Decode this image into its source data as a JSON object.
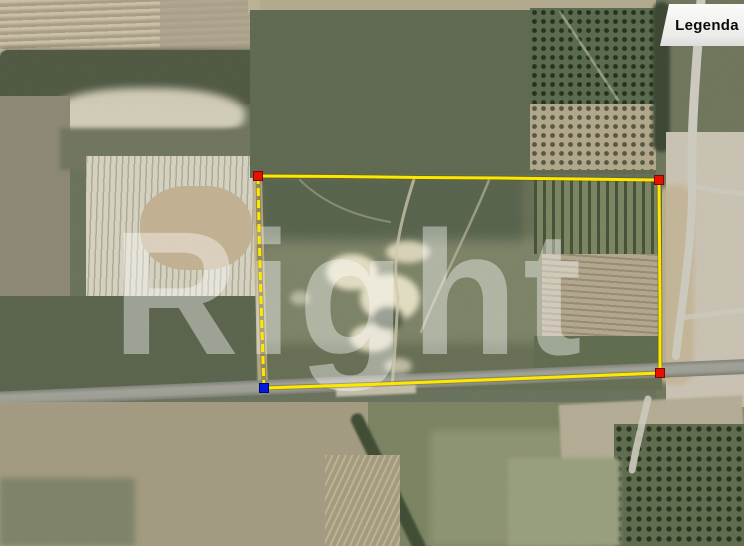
{
  "legend": {
    "label": "Legenda"
  },
  "watermark": {
    "text": "Right"
  },
  "parcel_overlay": {
    "boundary_color": "#ffe800",
    "vertex_marker_colors": {
      "top_left": "#e81000",
      "top_right": "#e81000",
      "bottom_right": "#e81000",
      "bottom_left": "#0018e8"
    }
  }
}
